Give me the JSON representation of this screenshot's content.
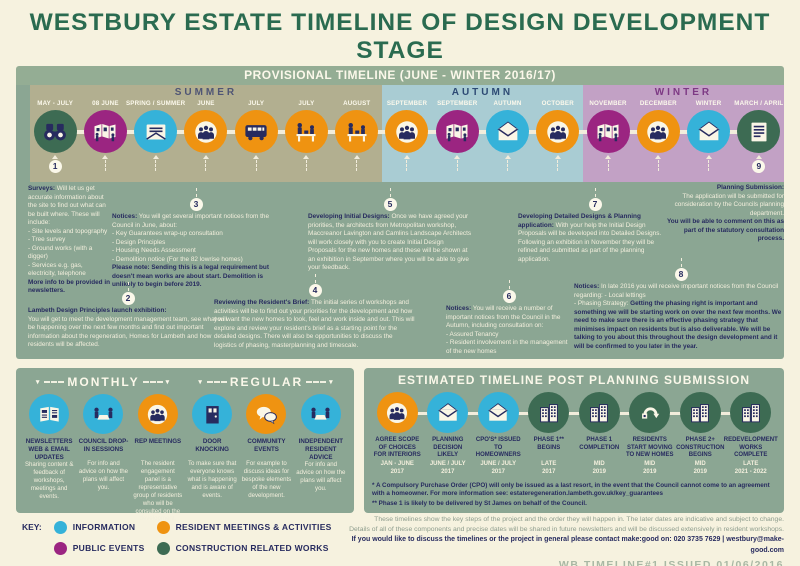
{
  "header": {
    "title": "WESTBURY ESTATE TIMELINE OF DESIGN DEVELOPMENT STAGE",
    "subtitle": "& HOW WE WOULD LIKE TO WORK WITH YOU"
  },
  "colors": {
    "information": "#35b2d9",
    "public": "#9b2581",
    "resident": "#ef9311",
    "construction": "#3d6b53",
    "accent_navy": "#272b5f",
    "cream": "#fbf8ea",
    "sage_panel": "#8ba693",
    "bar_green": "#94ad94",
    "page_bg": "#f6f2df",
    "title_green": "#2a6b50"
  },
  "provisional": {
    "bar_label": "PROVISIONAL TIMELINE (JUNE - WINTER 2016/17)",
    "seasons": [
      {
        "name": "SUMMER",
        "color": "#b2af90",
        "title_color": "#4f5575",
        "items": [
          {
            "month": "MAY - JULY",
            "icon": "binoculars-icon",
            "type": "construction",
            "badge": "1"
          },
          {
            "month": "08 JUNE",
            "icon": "exhibition-icon",
            "type": "public"
          },
          {
            "month": "SPRING / SUMMER",
            "icon": "letter-icon",
            "type": "information"
          },
          {
            "month": "JUNE",
            "icon": "group-icon",
            "type": "resident"
          },
          {
            "month": "JULY",
            "icon": "bus-icon",
            "type": "resident"
          },
          {
            "month": "JULY",
            "icon": "workshop-icon",
            "type": "resident"
          },
          {
            "month": "AUGUST",
            "icon": "workshop-icon",
            "type": "resident"
          }
        ]
      },
      {
        "name": "AUTUMN",
        "color": "#a9ccd3",
        "title_color": "#2d4a74",
        "items": [
          {
            "month": "SEPTEMBER",
            "icon": "group-icon",
            "type": "resident"
          },
          {
            "month": "SEPTEMBER",
            "icon": "exhibition-icon",
            "type": "public"
          },
          {
            "month": "AUTUMN",
            "icon": "envelope-open-icon",
            "type": "information"
          },
          {
            "month": "OCTOBER",
            "icon": "group-icon",
            "type": "resident"
          }
        ]
      },
      {
        "name": "WINTER",
        "color": "#c2a1c5",
        "title_color": "#7d3984",
        "items": [
          {
            "month": "NOVEMBER",
            "icon": "exhibition-icon",
            "type": "public"
          },
          {
            "month": "DECEMBER",
            "icon": "group-icon",
            "type": "resident"
          },
          {
            "month": "WINTER",
            "icon": "envelope-open-icon",
            "type": "information"
          },
          {
            "month": "MARCH / APRIL",
            "icon": "document-icon",
            "type": "construction",
            "badge": "9"
          }
        ]
      }
    ]
  },
  "panel_notes": [
    {
      "badge": "",
      "title": "Surveys:",
      "body": "Will let us get accurate information about the site to find out what can be built where. These will include:\n- Site levels and topography\n- Tree survey\n- Ground works (with a digger)\n- Services e.g. gas, electricity, telephone",
      "note": "\nMore info to be provided in newsletters."
    },
    {
      "badge": "3",
      "title": "Notices:",
      "body": "You will get several important notices from the Council in June, about:\n- Key Guarantees wrap-up consultation\n- Design Principles\n- Housing Needs Assessment\n- Demolition notice (For the 82 lowrise homes)",
      "note": "\nPlease note:  Sending this is a legal requirement but doesn't mean works are about start. Demolition is unlikely to begin before 2019."
    },
    {
      "badge": "2",
      "title": "Lambeth Design Principles launch exhibition:",
      "body": "\nYou will get to meet the development management team, see what will be happening over the next few months and find out important information about the regeneration, Homes for Lambeth and how residents will be affected.",
      "note": ""
    },
    {
      "badge": "4",
      "title": "Reviewing the Resident's Brief:",
      "body": "The initial series of workshops and activities will be to find out your priorities for the development and how you want the new homes to look, feel and work inside and out. This will explore and review your resident's brief as a starting point for the detailed designs. There will also be opportunities to discuss the logistics of phasing, masterplanning and timescale.",
      "note": ""
    },
    {
      "badge": "5",
      "title": "Developing Initial Designs:",
      "body": "Once we have agreed your priorities, the architects from Metropolitan workshop, Maccreanor Lavington and Camlins Landscape Architects will work closely with you to create Initial Design Proposals for the new homes and these will be shown at an exhibition in September where you will be able to give your feedback.",
      "note": ""
    },
    {
      "badge": "6",
      "title": "Notices:",
      "body": "You will receive a number of important notices from the Council in the Autumn, including consultation on:\n- Assured Tenancy\n- Resident involvement in the management of the new homes",
      "note": ""
    },
    {
      "badge": "7",
      "title": "Developing Detailed Designs & Planning application:",
      "body": "With your help the Initial Design Proposals will be developed into Detailed Designs. Following an exhibition in November they will be refined and submitted as part of the planning application.",
      "note": ""
    },
    {
      "badge": "8",
      "title": "Notices:",
      "body": "In late 2016 you will receive important notices from the Council regarding: - Local lettings\n- Phasing Strategy:",
      "note": "Getting the phasing right is important and something we will be starting work on over the next few months.  We need to make sure there is an effective phasing strategy that minimises impact on residents but is also deliverable.  We will be talking to you about this throughout the design development and it will be confirmed to you later in the year."
    },
    {
      "badge": "",
      "title": "Planning Submission:",
      "body": "\nThe application will be submitted for consideration by the Councils planning department.",
      "note": "\nYou will be able to comment on this as part of the statutory consultation process."
    }
  ],
  "monthly_regular": {
    "groups": [
      {
        "label": "MONTHLY",
        "items": [
          {
            "label": "NEWSLETTERS WEB & EMAIL UPDATES",
            "icon": "newspaper-icon",
            "type": "information",
            "desc": "Sharing content & feedback of workshops, meetings and events."
          },
          {
            "label": "COUNCIL DROP-IN SESSIONS",
            "icon": "meeting-table-icon",
            "type": "information",
            "desc": "For info and advice on how the plans will affect you."
          },
          {
            "label": "REP MEETINGS",
            "icon": "group-icon",
            "type": "resident",
            "desc": "The resident engagement panel is a representative group of residents who will be consulted on the development."
          }
        ]
      },
      {
        "label": "REGULAR",
        "items": [
          {
            "label": "DOOR KNOCKING",
            "icon": "door-icon",
            "type": "information",
            "desc": "To make sure that everyone knows what is happening and is aware of events."
          },
          {
            "label": "COMMUNITY EVENTS",
            "icon": "speech-bubbles-icon",
            "type": "resident",
            "desc": "For example to discuss ideas for bespoke elements of the new development."
          },
          {
            "label": "INDEPENDENT RESIDENT ADVICE",
            "icon": "meeting-table-icon",
            "type": "information",
            "desc": "For info and advice on how the plans will affect you."
          }
        ]
      }
    ]
  },
  "post_planning": {
    "title": "ESTIMATED TIMELINE POST PLANNING SUBMISSION",
    "items": [
      {
        "label": "AGREE SCOPE OF CHOICES FOR INTERIORS",
        "date": "JAN - JUNE\n2017",
        "icon": "group-icon",
        "type": "resident"
      },
      {
        "label": "PLANNING DECISION LIKELY",
        "date": "JUNE / JULY\n2017",
        "icon": "envelope-open-icon",
        "type": "information"
      },
      {
        "label": "CPO'S* ISSUED TO HOMEOWNERS",
        "date": "JUNE / JULY\n2017",
        "icon": "envelope-open-icon",
        "type": "information"
      },
      {
        "label": "PHASE 1** BEGINS",
        "date": "LATE\n2017",
        "icon": "buildings-icon",
        "type": "construction"
      },
      {
        "label": "PHASE 1 COMPLETION",
        "date": "MID\n2019",
        "icon": "buildings-icon",
        "type": "construction"
      },
      {
        "label": "RESIDENTS START MOVING TO NEW HOMES",
        "date": "MID\n2019",
        "icon": "moving-arrow-icon",
        "type": "construction"
      },
      {
        "label": "PHASE 2+ CONSTRUCTION BEGINS",
        "date": "MID\n2019",
        "icon": "buildings-icon",
        "type": "construction"
      },
      {
        "label": "REDEVELOPMENT WORKS COMPLETE",
        "date": "LATE\n2021 - 2022",
        "icon": "buildings-icon",
        "type": "construction"
      }
    ],
    "footnote1": "* A Compulsory Purchase Order (CPO) will only be issued as a last resort, in the event that the Council cannot come to an agreement with a homeowner. For more information see: estateregeneration.lambeth.gov.uk/key_guarantees",
    "footnote2": "** Phase 1 is likely to be delivered by St James on behalf of the Council."
  },
  "key": {
    "label": "KEY:",
    "entries": [
      {
        "label": "INFORMATION",
        "color": "#35b2d9"
      },
      {
        "label": "PUBLIC EVENTS",
        "color": "#9b2581"
      },
      {
        "label": "RESIDENT MEETINGS & ACTIVITIES",
        "color": "#ef9311"
      },
      {
        "label": "CONSTRUCTION RELATED WORKS",
        "color": "#3d6b53"
      }
    ]
  },
  "footer": {
    "line1": "These timelines show the key steps of the project and the order they will happen in. The later dates are indicative and subject to change.",
    "line2": "Details of all of these components and precise dates will be shared in future newsletters and will be discussed extensively in resident workshops.",
    "line3": "If you would like to discuss the timelines or the project in general please contact make:good on: 020 3735 7629 | westbury@make-good.com",
    "issue": "WB TIMELINE#1 ISSUED 01/06/2016"
  }
}
